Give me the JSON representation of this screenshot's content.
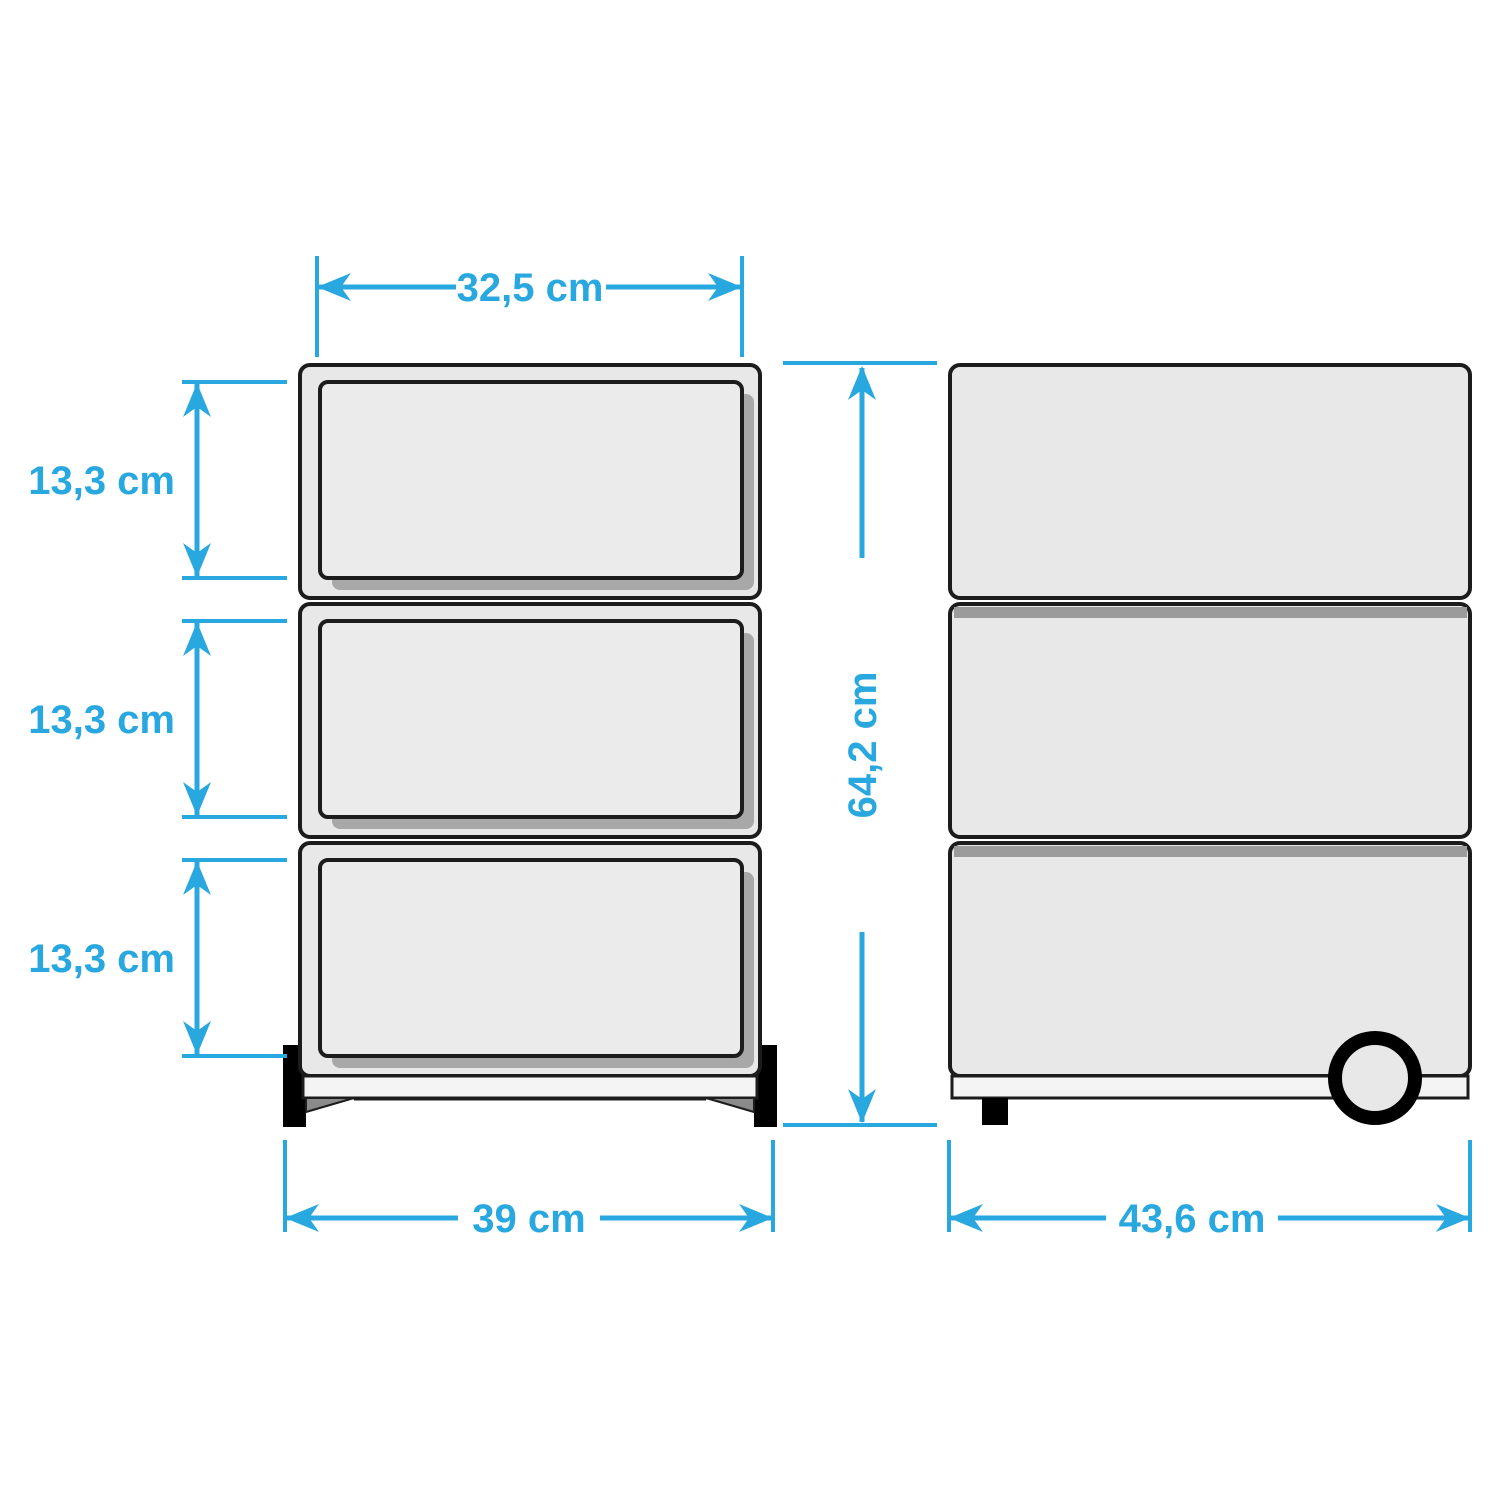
{
  "diagram": {
    "type": "product-dimension-drawing",
    "subject": "three-drawer rolling cabinet, front and side views",
    "views": [
      {
        "id": "front-view",
        "drawers": 3,
        "feet": 2
      },
      {
        "id": "side-view",
        "drawers": 3,
        "feet": 1,
        "wheel": true
      }
    ]
  },
  "labels": {
    "top_width": "32,5 cm",
    "drawer_height_1": "13,3 cm",
    "drawer_height_2": "13,3 cm",
    "drawer_height_3": "13,3 cm",
    "total_height": "64,2 cm",
    "front_width": "39 cm",
    "side_depth": "43,6 cm"
  },
  "colors": {
    "dimension_cyan": "#29A8DF",
    "outline_dark": "#1C1C1C",
    "body_fill": "#E8E8E8",
    "drawer_fill": "#EBEBEB",
    "shadow_gray": "#A8A8A8",
    "separator_gray": "#9B9B9B",
    "plinth_fill": "#F4F4F4",
    "wedge_gray": "#8A8A8A",
    "feet_black": "#000000",
    "background": "#FFFFFF"
  }
}
